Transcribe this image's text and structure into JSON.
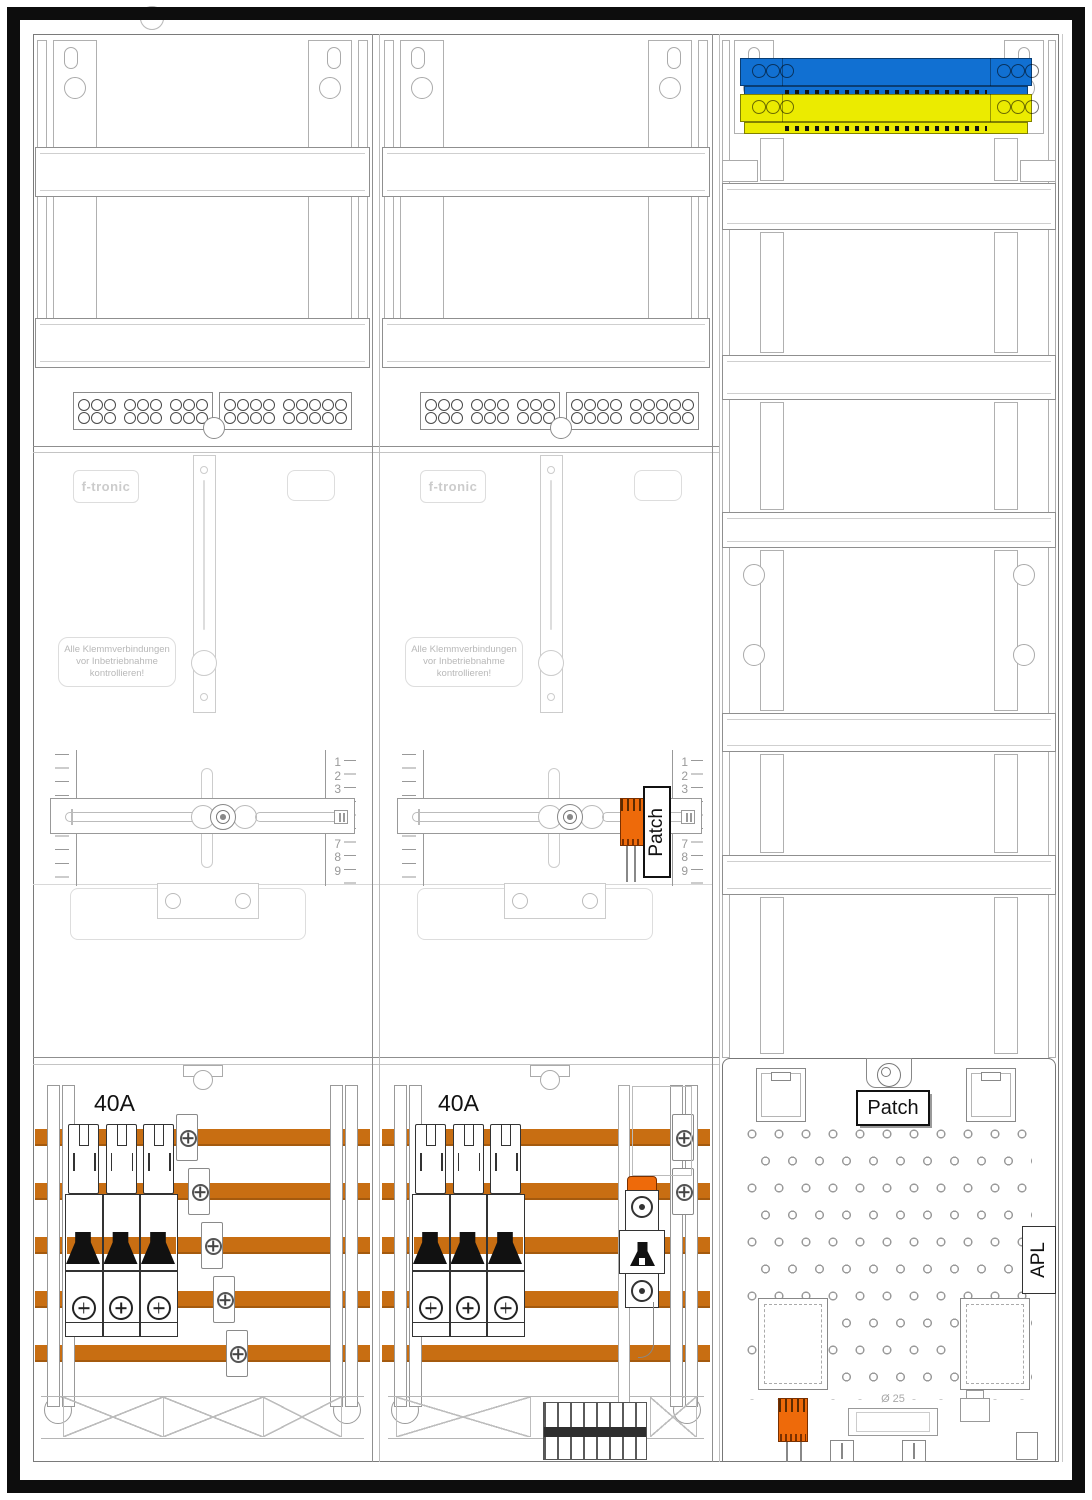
{
  "colors": {
    "busbar_copper": "#C86E12",
    "neutral_bar_blue": "#1170D2",
    "pe_bar_yellow": "#EBEB00",
    "connector_orange": "#EE6A0A",
    "breaker_toggle_black": "#111111"
  },
  "meter_columns": [
    {
      "amp_label": "40A",
      "logo": "f-tronic",
      "warning_lines": [
        "Alle Klemmverbindungen",
        "vor Inbetriebnahme",
        "kontrollieren!"
      ]
    },
    {
      "amp_label": "40A",
      "logo": "f-tronic",
      "warning_lines": [
        "Alle Klemmverbindungen",
        "vor Inbetriebnahme",
        "kontrollieren!"
      ],
      "patch_label": "Patch"
    }
  ],
  "ruler_numbers": [
    "1",
    "2",
    "3",
    "4",
    "5",
    "6",
    "7",
    "8",
    "9"
  ],
  "right_column": {
    "patch_label": "Patch",
    "apl_label": "APL",
    "diameter_label": "Ø 25"
  }
}
